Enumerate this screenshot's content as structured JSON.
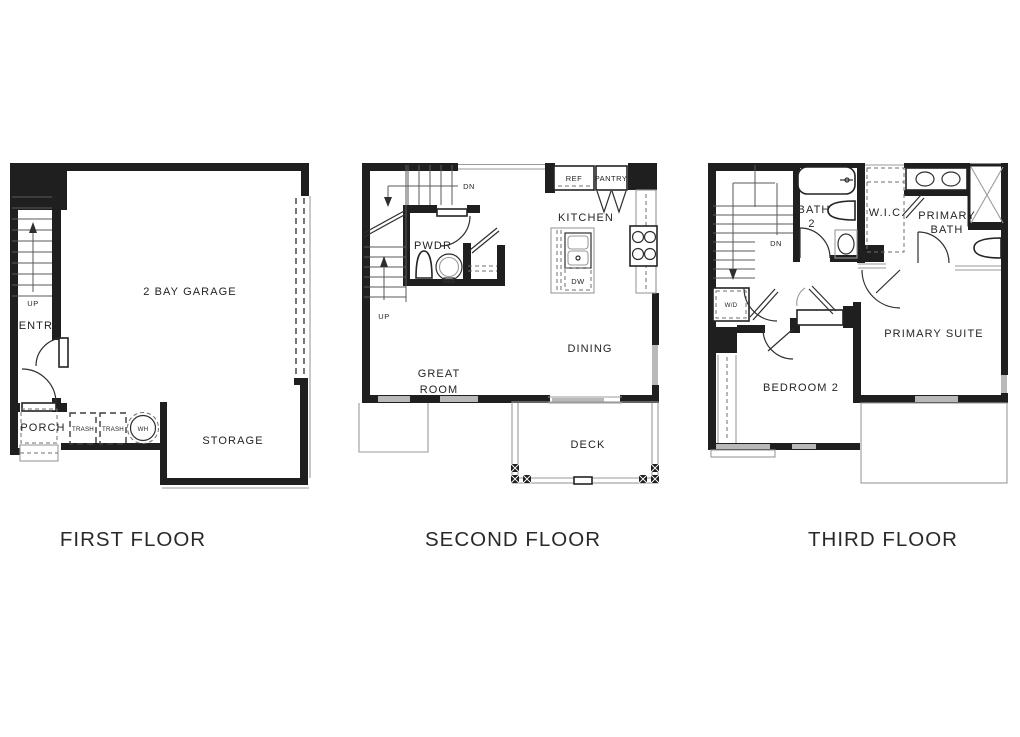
{
  "colors": {
    "wall": "#1f1f1f",
    "line": "#2f2f2f",
    "thin_gray": "#9a9a9a",
    "window_gray": "#b9b9b9",
    "background": "#ffffff",
    "text": "#262324"
  },
  "floors": {
    "first": {
      "title": "FIRST FLOOR",
      "labels": {
        "up": "UP",
        "entry": "ENTRY",
        "garage": "2 BAY GARAGE",
        "porch": "PORCH",
        "trash_left": "TRASH",
        "trash_right": "TRASH",
        "water_heater": "WH",
        "storage": "STORAGE"
      }
    },
    "second": {
      "title": "SECOND FLOOR",
      "labels": {
        "dn": "DN",
        "up": "UP",
        "powder": "PWDR",
        "ref": "REF",
        "pantry": "PANTRY",
        "kitchen": "KITCHEN",
        "dishwasher": "DW",
        "great_line1": "GREAT",
        "great_line2": "ROOM",
        "dining": "DINING",
        "deck": "DECK"
      }
    },
    "third": {
      "title": "THIRD FLOOR",
      "labels": {
        "dn": "DN",
        "washer_dryer": "W/D",
        "bath2_line1": "BATH",
        "bath2_line2": "2",
        "wic": "W.I.C.",
        "primary_bath_line1": "PRIMARY",
        "primary_bath_line2": "BATH",
        "primary_suite": "PRIMARY SUITE",
        "bedroom2": "BEDROOM 2"
      }
    }
  }
}
